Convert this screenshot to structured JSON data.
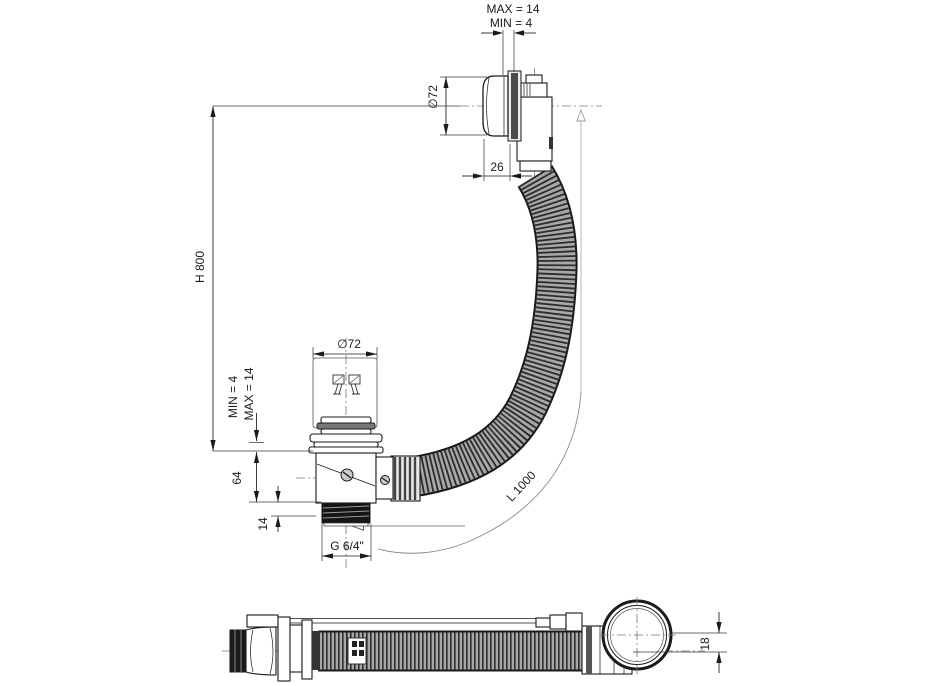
{
  "drawing": {
    "type": "technical-drawing",
    "subject": "bath waste and overflow fitting with flexible hose, side elevation and plan view",
    "background_color": "#ffffff",
    "line_color": "#1a1a1a",
    "dimensions": {
      "panel_thickness_max": "MAX = 14",
      "panel_thickness_min": "MIN = 4",
      "knob_diameter": "∅72",
      "knob_depth": "26",
      "overflow_height": "H 800",
      "plug_diameter": "∅72",
      "floor_thickness_min": "MIN = 4",
      "floor_thickness_max": "MAX = 14",
      "body_height": "64",
      "thread_length": "14",
      "thread_size": "G 6/4\"",
      "hose_length": "L 1000",
      "knob_offset": "18"
    }
  }
}
